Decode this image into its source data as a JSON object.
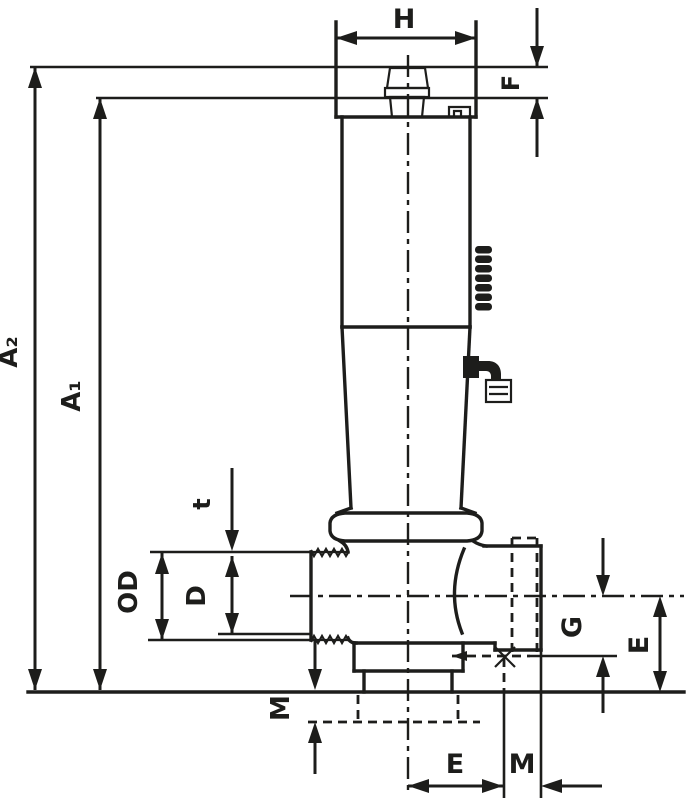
{
  "page": {
    "title": "Valve dimensional cross-section drawing",
    "background_color": "#ffffff",
    "line_color": "#1d1d1b"
  },
  "labels": {
    "h": "H",
    "f": "F",
    "a2": "A₂",
    "a1": "A₁",
    "t": "t",
    "od": "OD",
    "d": "D",
    "m_left": "M",
    "g": "G",
    "e_right": "E",
    "e_bottom": "E",
    "m_bottom": "M"
  },
  "features": {
    "knurl_icon": "knurl-pattern",
    "thread_icon": "thread-serration",
    "hidden_thread_icon": "hidden-thread-dashed",
    "centerline_icon": "center-line",
    "cross_mark_icon": "centerline-cross"
  }
}
